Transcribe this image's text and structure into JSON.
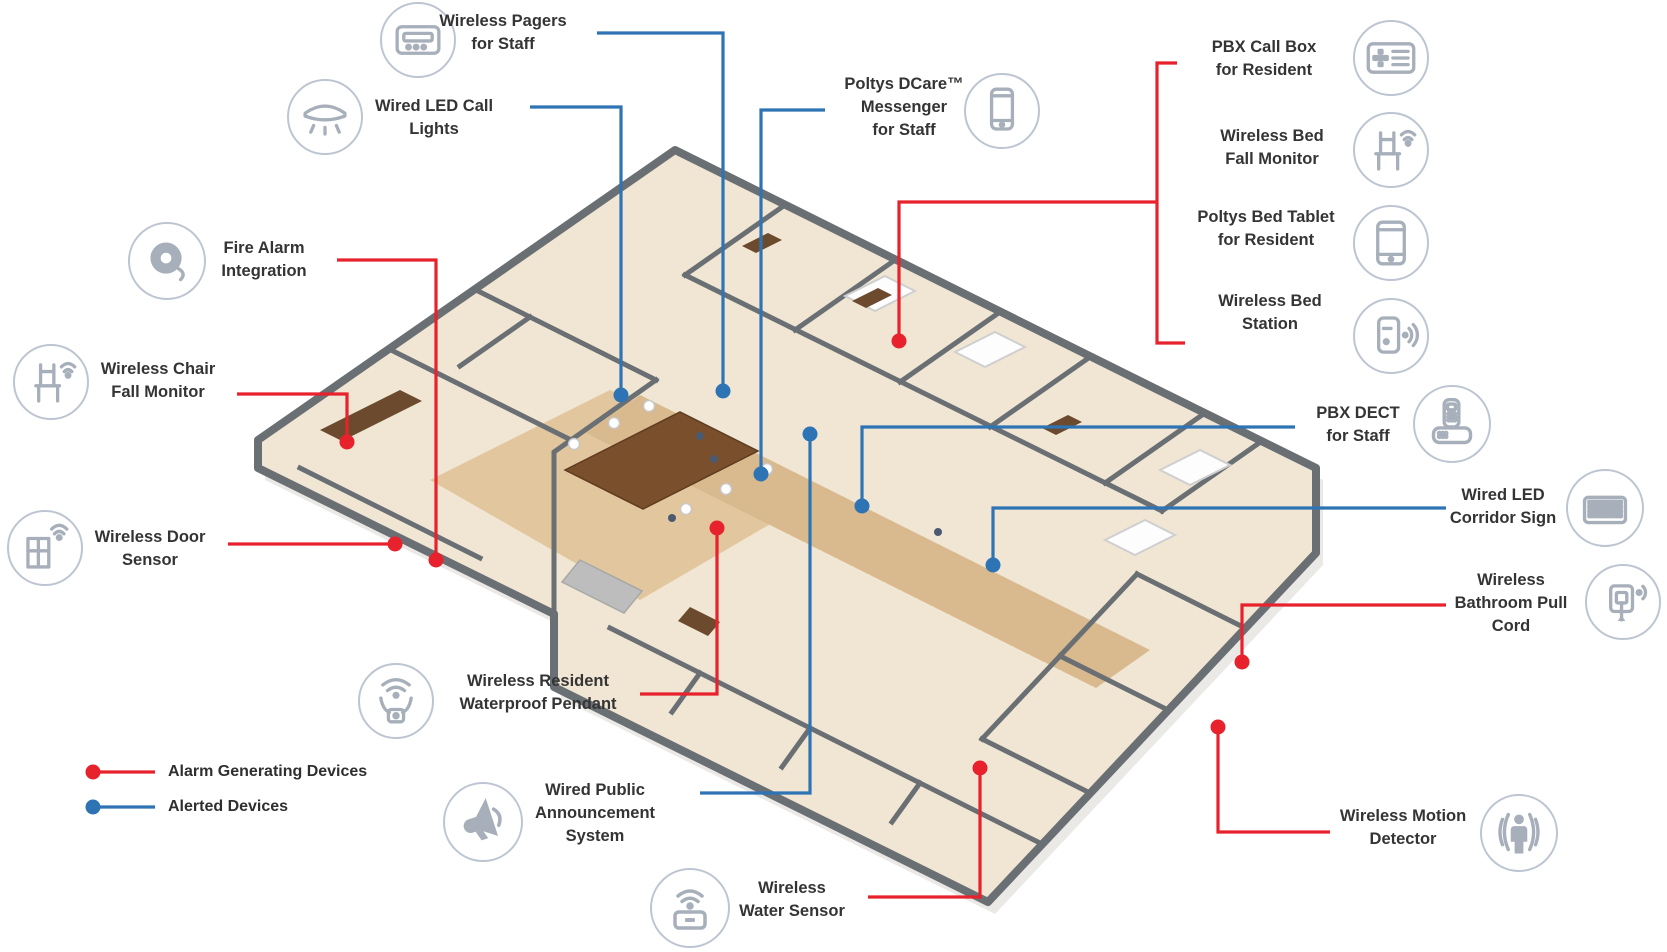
{
  "colors": {
    "alarm": "#e8222d",
    "alerted": "#2e74b5",
    "icon_circle": "#bcc5d1",
    "icon_glyph": "#a7afbb",
    "label_text": "#343434"
  },
  "legend": {
    "items": [
      {
        "id": "alarm",
        "label": "Alarm Generating Devices",
        "color": "#e8222d",
        "dot": [
          93,
          772
        ],
        "line_end_x": 155,
        "text_x": 168
      },
      {
        "id": "alerted",
        "label": "Alerted Devices",
        "color": "#2e74b5",
        "dot": [
          93,
          807
        ],
        "line_end_x": 155,
        "text_x": 168
      }
    ]
  },
  "devices": [
    {
      "id": "wireless-pagers",
      "label_lines": [
        "Wireless Pagers",
        "for Staff"
      ],
      "device_type": "alerted",
      "icon": "pager",
      "icon_center": [
        418,
        40
      ],
      "icon_r": 38,
      "text_box": [
        503,
        10,
        160
      ],
      "connector": [
        [
          597,
          33
        ],
        [
          723,
          33
        ],
        [
          723,
          391
        ]
      ],
      "dot": [
        723,
        391
      ]
    },
    {
      "id": "wired-led-call-lights",
      "label_lines": [
        "Wired LED Call",
        "Lights"
      ],
      "device_type": "alerted",
      "icon": "ceiling-light",
      "icon_center": [
        325,
        117
      ],
      "icon_r": 38,
      "text_box": [
        434,
        95,
        160
      ],
      "connector": [
        [
          530,
          107
        ],
        [
          621,
          107
        ],
        [
          621,
          395
        ]
      ],
      "dot": [
        621,
        395
      ]
    },
    {
      "id": "poltys-dcare-messenger",
      "label_lines": [
        "Poltys DCare™",
        "Messenger",
        "for Staff"
      ],
      "device_type": "alerted",
      "icon": "smartphone",
      "icon_center": [
        1002,
        111
      ],
      "icon_r": 38,
      "text_box": [
        904,
        73,
        170
      ],
      "connector": [
        [
          825,
          110
        ],
        [
          761,
          110
        ],
        [
          761,
          474
        ]
      ],
      "dot": [
        761,
        474
      ]
    },
    {
      "id": "pbx-call-box",
      "label_lines": [
        "PBX Call Box",
        "for Resident"
      ],
      "device_type": "alarm",
      "icon": "callbox",
      "icon_center": [
        1391,
        58
      ],
      "icon_r": 38,
      "text_box": [
        1264,
        36,
        180
      ]
    },
    {
      "id": "wireless-bed-fall-monitor",
      "label_lines": [
        "Wireless Bed",
        "Fall Monitor"
      ],
      "device_type": "alarm",
      "icon": "bed-fall",
      "icon_center": [
        1391,
        150
      ],
      "icon_r": 38,
      "text_box": [
        1272,
        125,
        170
      ]
    },
    {
      "id": "poltys-bed-tablet",
      "label_lines": [
        "Poltys Bed Tablet",
        "for Resident"
      ],
      "device_type": "alarm",
      "icon": "tablet",
      "icon_center": [
        1391,
        243
      ],
      "icon_r": 38,
      "text_box": [
        1266,
        206,
        190
      ]
    },
    {
      "id": "wireless-bed-station",
      "label_lines": [
        "Wireless Bed",
        "Station"
      ],
      "device_type": "alarm",
      "icon": "bed-station",
      "icon_center": [
        1391,
        336
      ],
      "icon_r": 38,
      "text_box": [
        1270,
        290,
        170
      ]
    },
    {
      "id": "fire-alarm-integration",
      "label_lines": [
        "Fire Alarm",
        "Integration"
      ],
      "device_type": "alarm",
      "icon": "fire-bell",
      "icon_center": [
        167,
        261
      ],
      "icon_r": 39,
      "text_box": [
        264,
        237,
        150
      ],
      "connector": [
        [
          337,
          260
        ],
        [
          436,
          260
        ],
        [
          436,
          560
        ]
      ],
      "dot": [
        436,
        560
      ]
    },
    {
      "id": "wireless-chair-fall-monitor",
      "label_lines": [
        "Wireless Chair",
        "Fall Monitor"
      ],
      "device_type": "alarm",
      "icon": "chair-wifi",
      "icon_center": [
        51,
        382
      ],
      "icon_r": 38,
      "text_box": [
        158,
        358,
        160
      ],
      "connector": [
        [
          237,
          394
        ],
        [
          347,
          394
        ],
        [
          347,
          442
        ]
      ],
      "dot": [
        347,
        442
      ]
    },
    {
      "id": "wireless-door-sensor",
      "label_lines": [
        "Wireless Door",
        "Sensor"
      ],
      "device_type": "alarm",
      "icon": "door-wifi",
      "icon_center": [
        45,
        548
      ],
      "icon_r": 38,
      "text_box": [
        150,
        526,
        160
      ],
      "connector": [
        [
          228,
          544
        ],
        [
          395,
          544
        ]
      ],
      "dot": [
        395,
        544
      ]
    },
    {
      "id": "wireless-resident-waterproof-pendant",
      "label_lines": [
        "Wireless Resident",
        "Waterproof  Pendant"
      ],
      "device_type": "alarm",
      "icon": "pendant-wifi",
      "icon_center": [
        396,
        701
      ],
      "icon_r": 38,
      "text_box": [
        538,
        670,
        220
      ],
      "connector": [
        [
          640,
          694
        ],
        [
          717,
          694
        ],
        [
          717,
          528
        ]
      ],
      "dot": [
        717,
        528
      ]
    },
    {
      "id": "wired-public-announcement-system",
      "label_lines": [
        "Wired Public",
        "Announcement",
        "System"
      ],
      "device_type": "alerted",
      "icon": "megaphone",
      "icon_center": [
        483,
        822
      ],
      "icon_r": 40,
      "text_box": [
        595,
        779,
        170
      ],
      "connector": [
        [
          700,
          793
        ],
        [
          810,
          793
        ],
        [
          810,
          434
        ]
      ],
      "dot": [
        810,
        434
      ]
    },
    {
      "id": "wireless-water-sensor",
      "label_lines": [
        "Wireless",
        "Water Sensor"
      ],
      "device_type": "alarm",
      "icon": "water-wifi",
      "icon_center": [
        690,
        908
      ],
      "icon_r": 40,
      "text_box": [
        792,
        877,
        150
      ],
      "connector": [
        [
          868,
          897
        ],
        [
          980,
          897
        ],
        [
          980,
          768
        ]
      ],
      "dot": [
        980,
        768
      ]
    },
    {
      "id": "pbx-dect",
      "label_lines": [
        "PBX DECT",
        "for Staff"
      ],
      "device_type": "alerted",
      "icon": "dect-phone",
      "icon_center": [
        1452,
        424
      ],
      "icon_r": 39,
      "text_box": [
        1358,
        402,
        130
      ],
      "connector": [
        [
          1295,
          427
        ],
        [
          862,
          427
        ],
        [
          862,
          506
        ]
      ],
      "dot": [
        862,
        506
      ]
    },
    {
      "id": "wired-led-corridor-sign",
      "label_lines": [
        "Wired LED",
        "Corridor Sign"
      ],
      "device_type": "alerted",
      "icon": "led-matrix",
      "icon_center": [
        1605,
        508
      ],
      "icon_r": 39,
      "text_box": [
        1503,
        484,
        150
      ],
      "connector": [
        [
          1446,
          508
        ],
        [
          993,
          508
        ],
        [
          993,
          565
        ]
      ],
      "dot": [
        993,
        565
      ]
    },
    {
      "id": "wireless-bathroom-pull-cord",
      "label_lines": [
        "Wireless",
        "Bathroom Pull",
        "Cord"
      ],
      "device_type": "alarm",
      "icon": "pullcord-wifi",
      "icon_center": [
        1623,
        602
      ],
      "icon_r": 38,
      "text_box": [
        1511,
        569,
        160
      ],
      "connector": [
        [
          1446,
          605
        ],
        [
          1242,
          605
        ],
        [
          1242,
          662
        ]
      ],
      "dot": [
        1242,
        662
      ]
    },
    {
      "id": "wireless-motion-detector",
      "label_lines": [
        "Wireless Motion",
        "Detector"
      ],
      "device_type": "alarm",
      "icon": "motion-person",
      "icon_center": [
        1519,
        833
      ],
      "icon_r": 39,
      "text_box": [
        1403,
        805,
        180
      ],
      "connector": [
        [
          1330,
          832
        ],
        [
          1218,
          832
        ],
        [
          1218,
          727
        ]
      ],
      "dot": [
        1218,
        727
      ]
    }
  ],
  "group_connector": {
    "id": "bed-device-group",
    "device_type": "alarm",
    "segments": [
      [
        [
          1177,
          63
        ],
        [
          1157,
          63
        ],
        [
          1157,
          343
        ],
        [
          1185,
          343
        ]
      ],
      [
        [
          1157,
          202
        ],
        [
          899,
          202
        ],
        [
          899,
          341
        ]
      ]
    ],
    "dot": [
      899,
      341
    ]
  }
}
